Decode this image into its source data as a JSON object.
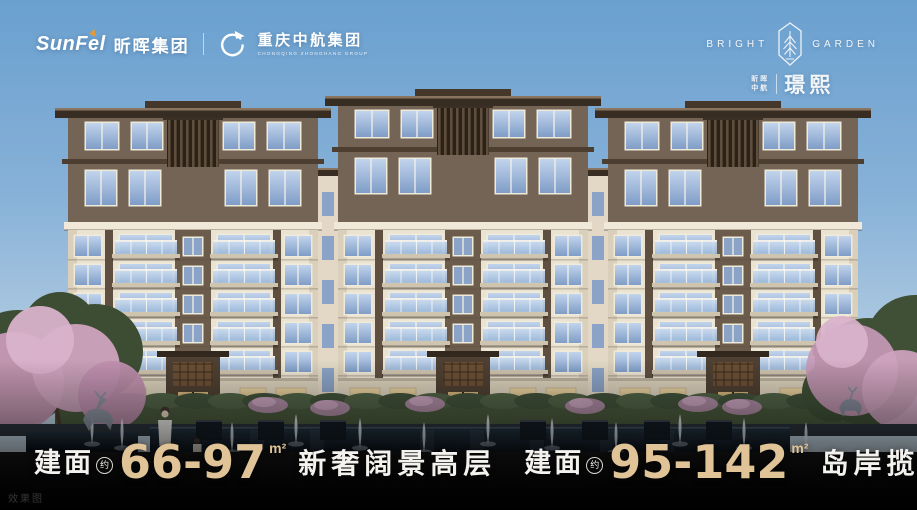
{
  "header": {
    "sunfel_logo_text": "SunFel",
    "sunfel_cn": "昕晖集团",
    "zhonghang_cn": "重庆中航集团",
    "zhonghang_en": "CHONGQING ZHONGHANG GROUP"
  },
  "emblem": {
    "left_word": "BRIGHT",
    "right_word": "GARDEN",
    "sub_line1": "昕晖",
    "sub_line2": "中航",
    "project_name": "璟熙"
  },
  "tagline": {
    "items": [
      {
        "prefix": "建面",
        "approx": "约",
        "range": "66-97",
        "unit": "m²",
        "title": "新奢阔景高层"
      },
      {
        "prefix": "建面",
        "approx": "约",
        "range": "95-142",
        "unit": "m²",
        "title": "岛岸揽景洋房"
      }
    ]
  },
  "watermark": "效果图",
  "colors": {
    "accent_gold": "#e0c396",
    "sky_top": "#6aa0cf",
    "facade_cream": "#ebe3d2",
    "penthouse_brown": "#746455",
    "roof_dark": "#382d22",
    "glass_blue": "#8fa9cc",
    "blossom_pink": "#cfa3bf"
  }
}
